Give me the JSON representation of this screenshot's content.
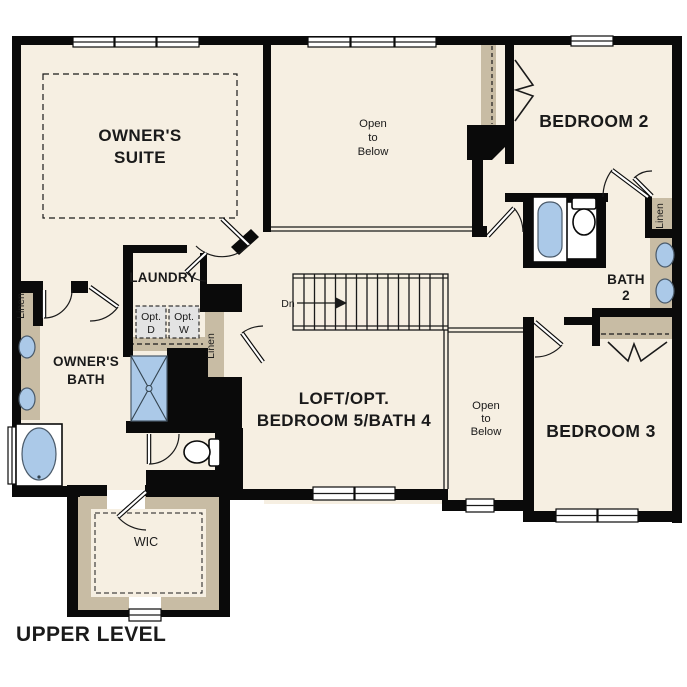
{
  "title": "UPPER LEVEL",
  "colors": {
    "floor": "#f6efe2",
    "wall": "#0a0a0a",
    "tan": "#c8bca4",
    "fixture_blue": "#abc9e8",
    "appliance_gray": "#e3e3e3",
    "line": "#1a1a1a"
  },
  "rooms": {
    "owners_suite": [
      "OWNER'S",
      "SUITE"
    ],
    "open_to_below": [
      "Open",
      "to",
      "Below"
    ],
    "bedroom2": "BEDROOM 2",
    "laundry": "LAUNDRY",
    "owners_bath": [
      "OWNER'S",
      "BATH"
    ],
    "loft": [
      "LOFT/OPT.",
      "BEDROOM 5/BATH 4"
    ],
    "bedroom3": "BEDROOM 3",
    "bath2": [
      "BATH",
      "2"
    ],
    "wic": "WIC"
  },
  "labels": {
    "linen": "Linen",
    "dn": "Dn",
    "opt_dryer": [
      "Opt.",
      "D"
    ],
    "opt_washer": [
      "Opt.",
      "W"
    ]
  }
}
